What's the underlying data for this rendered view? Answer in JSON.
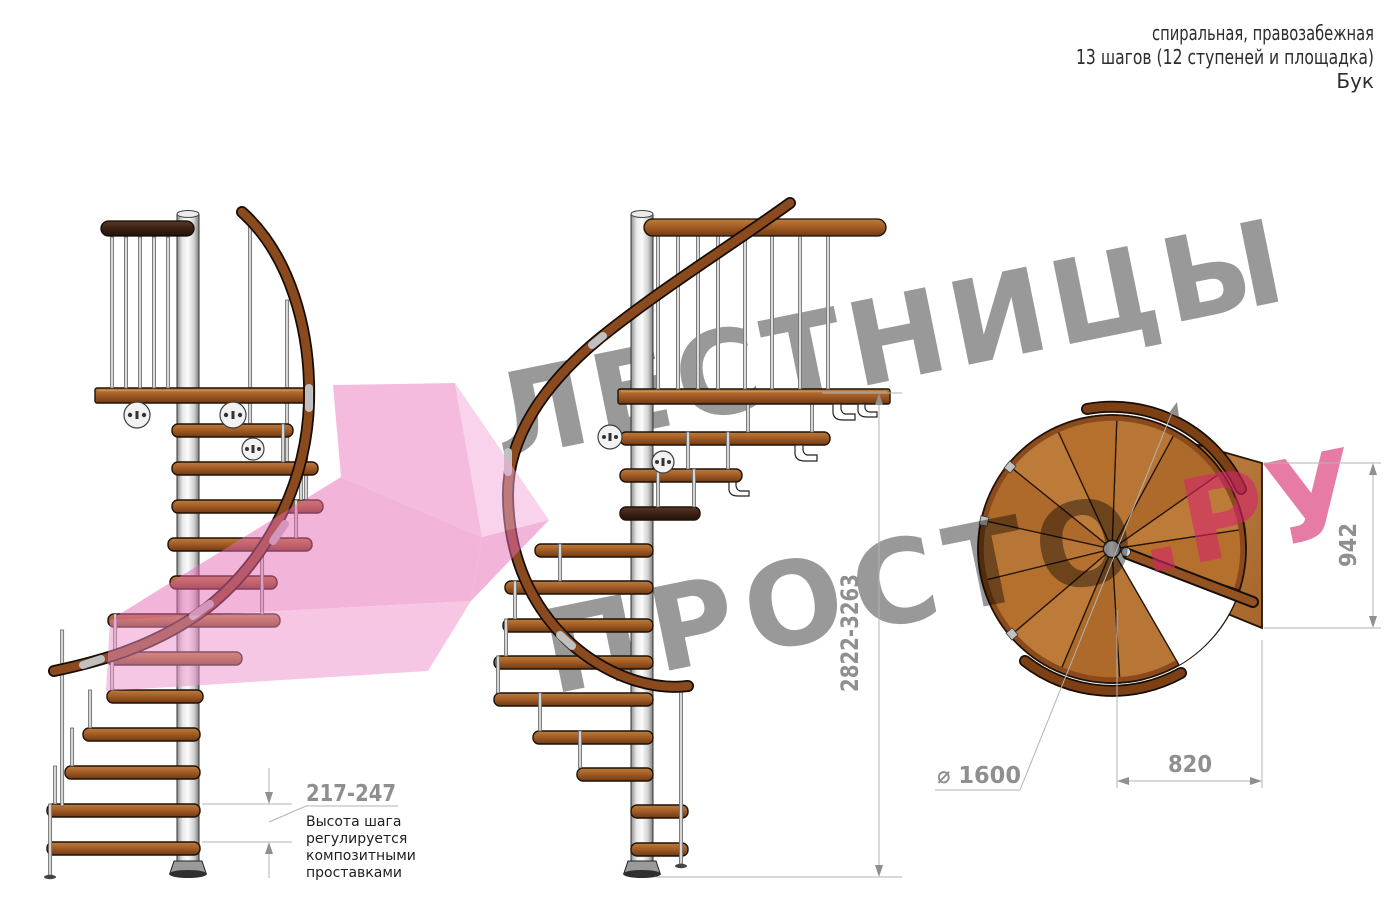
{
  "header": {
    "line1": "спиральная, правозабежная",
    "line2": "13 шагов (12 ступеней и площадка)",
    "line3": "Бук"
  },
  "watermark": {
    "brand_top": "ЛЕСТНИЦЫ",
    "brand_bottom": "ПРОСТО",
    "brand_suffix": ".РУ",
    "gray_color": "#9a9a9a",
    "pink_color": "#d6246a",
    "arrow_pink": "#ec87c6"
  },
  "dimensions": {
    "total_height": "2822-3263",
    "step_pitch": "217-247",
    "landing_depth": "942",
    "landing_width": "820",
    "diameter": "⌀ 1600"
  },
  "annotations": {
    "step_note": {
      "lines": [
        "Высота шага",
        "регулируется",
        "композитными",
        "проставками"
      ]
    }
  },
  "colors": {
    "wood_step": "#a05a24",
    "wood_rail": "#8a4a1e",
    "dark_rail": "#3a2114",
    "pole_metal": "#cfcfcf",
    "dimension_line": "#b3b3b3"
  }
}
